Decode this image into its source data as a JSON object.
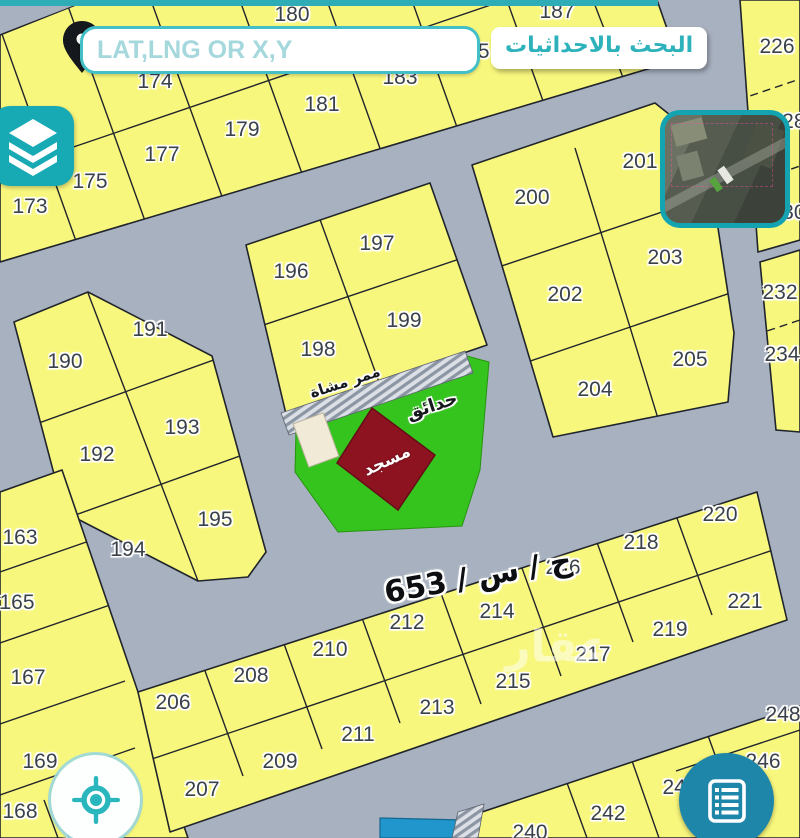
{
  "ui": {
    "search": {
      "placeholder": "LAT,LNG OR X,Y",
      "label": "البحث بالاحداثيات"
    },
    "icons": {
      "pin": "map-pin",
      "layers": "layers",
      "locate": "crosshair",
      "list": "list",
      "basemap": "satellite-thumbnail"
    }
  },
  "map": {
    "street_label": "ج / س / 653",
    "labels": {
      "park": "حدائق",
      "walkway": "ممر مشاة",
      "mosque": "مسجد"
    },
    "watermark": "عقار",
    "colors": {
      "parcel_fill": "#f8f77d",
      "street": "#a8b1c0",
      "park_green": "#35c31e",
      "mosque_red": "#8e1321",
      "accent_teal": "#17a9b4",
      "button_blue": "#1e86a8",
      "water_blue": "#2196cd"
    },
    "parcels": [
      {
        "label": "180",
        "x": 292,
        "y": 15
      },
      {
        "label": "183",
        "x": 400,
        "y": 78
      },
      {
        "label": "185",
        "x": 472,
        "y": 52
      },
      {
        "label": "187",
        "x": 557,
        "y": 12
      },
      {
        "label": "174",
        "x": 155,
        "y": 82
      },
      {
        "label": "173",
        "x": 30,
        "y": 207
      },
      {
        "label": "175",
        "x": 90,
        "y": 182
      },
      {
        "label": "177",
        "x": 162,
        "y": 155
      },
      {
        "label": "179",
        "x": 242,
        "y": 130
      },
      {
        "label": "181",
        "x": 322,
        "y": 105
      },
      {
        "label": "190",
        "x": 65,
        "y": 362
      },
      {
        "label": "191",
        "x": 150,
        "y": 330
      },
      {
        "label": "192",
        "x": 97,
        "y": 455
      },
      {
        "label": "193",
        "x": 182,
        "y": 428
      },
      {
        "label": "194",
        "x": 128,
        "y": 550
      },
      {
        "label": "195",
        "x": 215,
        "y": 520
      },
      {
        "label": "196",
        "x": 291,
        "y": 272
      },
      {
        "label": "197",
        "x": 377,
        "y": 244
      },
      {
        "label": "198",
        "x": 318,
        "y": 350
      },
      {
        "label": "199",
        "x": 404,
        "y": 321
      },
      {
        "label": "200",
        "x": 532,
        "y": 198
      },
      {
        "label": "201",
        "x": 640,
        "y": 162
      },
      {
        "label": "202",
        "x": 565,
        "y": 295
      },
      {
        "label": "203",
        "x": 665,
        "y": 258
      },
      {
        "label": "204",
        "x": 595,
        "y": 390
      },
      {
        "label": "205",
        "x": 690,
        "y": 360
      },
      {
        "label": "226",
        "x": 777,
        "y": 47
      },
      {
        "label": "228",
        "x": 788,
        "y": 122
      },
      {
        "label": "230",
        "x": 788,
        "y": 213
      },
      {
        "label": "232",
        "x": 780,
        "y": 293
      },
      {
        "label": "234",
        "x": 782,
        "y": 355
      },
      {
        "label": "163",
        "x": 20,
        "y": 538
      },
      {
        "label": "165",
        "x": 17,
        "y": 603
      },
      {
        "label": "167",
        "x": 28,
        "y": 678
      },
      {
        "label": "169",
        "x": 40,
        "y": 762
      },
      {
        "label": "168",
        "x": 20,
        "y": 812
      },
      {
        "label": "171",
        "x": 80,
        "y": 835
      },
      {
        "label": "206",
        "x": 173,
        "y": 703
      },
      {
        "label": "207",
        "x": 202,
        "y": 790
      },
      {
        "label": "208",
        "x": 251,
        "y": 676
      },
      {
        "label": "209",
        "x": 280,
        "y": 762
      },
      {
        "label": "210",
        "x": 330,
        "y": 650
      },
      {
        "label": "211",
        "x": 358,
        "y": 735
      },
      {
        "label": "212",
        "x": 407,
        "y": 623
      },
      {
        "label": "213",
        "x": 437,
        "y": 708
      },
      {
        "label": "214",
        "x": 497,
        "y": 612
      },
      {
        "label": "215",
        "x": 513,
        "y": 682
      },
      {
        "label": "216",
        "x": 563,
        "y": 568
      },
      {
        "label": "217",
        "x": 593,
        "y": 655
      },
      {
        "label": "218",
        "x": 641,
        "y": 543
      },
      {
        "label": "219",
        "x": 670,
        "y": 630
      },
      {
        "label": "220",
        "x": 720,
        "y": 515
      },
      {
        "label": "221",
        "x": 745,
        "y": 602
      },
      {
        "label": "240",
        "x": 530,
        "y": 833
      },
      {
        "label": "242",
        "x": 608,
        "y": 814
      },
      {
        "label": "244",
        "x": 680,
        "y": 788
      },
      {
        "label": "246",
        "x": 763,
        "y": 762
      },
      {
        "label": "248",
        "x": 783,
        "y": 715
      }
    ]
  }
}
